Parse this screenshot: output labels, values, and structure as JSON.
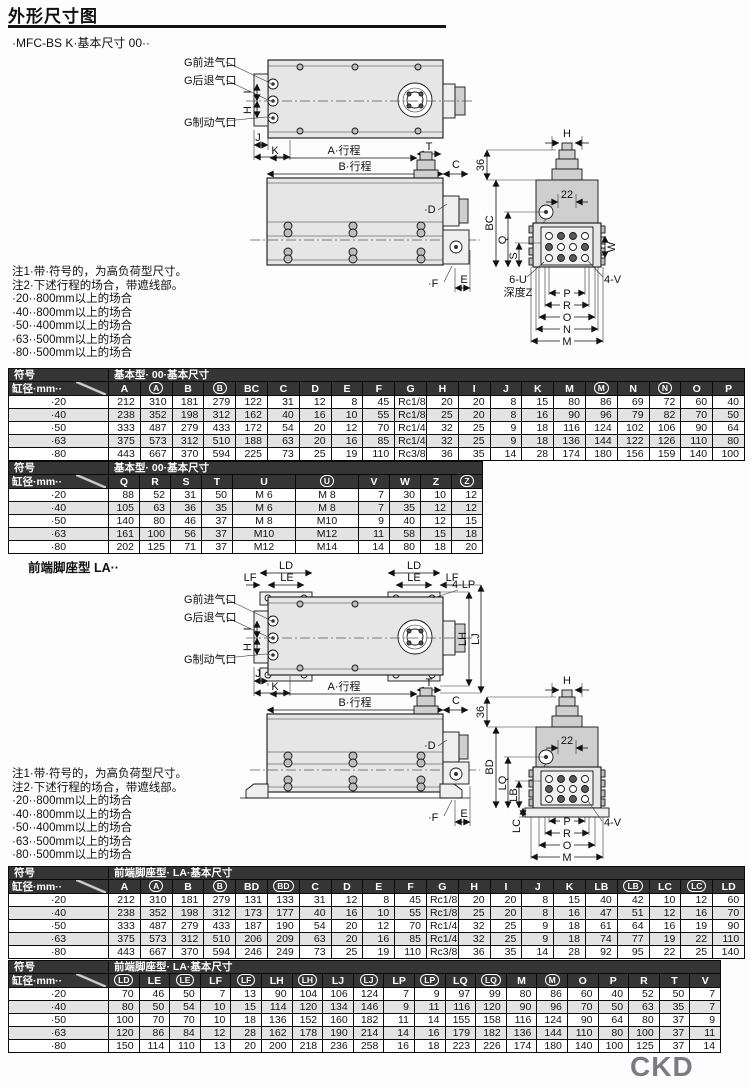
{
  "page": {
    "title": "外形尺寸图",
    "subtitle": "·MFC-BS K·基本尺寸 00··",
    "section2_heading": "前端脚座型 LA··",
    "brand": "CKD"
  },
  "notes": {
    "note1": "注1·带·符号的，为高负荷型尺寸。",
    "note2": "注2·下述行程的场合，带遮线部。",
    "bullets": [
      "·20··800mm以上的场合",
      "·40··800mm以上的场合",
      "·50··400mm以上的场合",
      "·63··500mm以上的场合",
      "·80··500mm以上的场合"
    ]
  },
  "drawing1": {
    "ports": {
      "advance": "G前进气口",
      "retract": "G后退气口",
      "brake": "G制动气口"
    },
    "dims": {
      "port_i": "I",
      "port_h": "H",
      "j": "J",
      "k": "K",
      "a_stroke": "A·行程",
      "b_stroke": "B·行程",
      "t": "T",
      "c": "C",
      "d": "·D",
      "e": "E",
      "f": "·F",
      "ev_h": "H",
      "n36": "36",
      "n22": "22",
      "bc": "BC",
      "q": "Q",
      "s": "S",
      "w": "W",
      "u6": "6-U",
      "depth_z": "深度Z",
      "v4": "4-V",
      "p": "P",
      "r": "R",
      "o": "O",
      "n": "N",
      "m": "M"
    }
  },
  "drawing2": {
    "ports": {
      "advance": "G前进气口",
      "retract": "G后退气口",
      "brake": "G制动气口"
    },
    "dims": {
      "ld": "LD",
      "le": "LE",
      "lf": "LF",
      "lp4": "4-LP",
      "lh": "LH",
      "lj": "LJ",
      "port_i": "I",
      "port_h": "H",
      "j": "J",
      "k": "K",
      "a_stroke": "A·行程",
      "b_stroke": "B·行程",
      "t": "T",
      "c": "C",
      "d": "·D",
      "e": "E",
      "f": "·F",
      "ev_h": "H",
      "n36": "36",
      "n22": "22",
      "bd": "BD",
      "lq": "LQ",
      "lb": "LB",
      "lc": "LC",
      "v4": "4-V",
      "p": "P",
      "r": "R",
      "o": "O",
      "m": "M"
    }
  },
  "tables": {
    "t1": {
      "symbol_label": "符号",
      "bore_label": "缸径·mm··",
      "title": "基本型· 00·基本尺寸",
      "columns": [
        "A",
        "(A)",
        "B",
        "(B)",
        "BC",
        "C",
        "D",
        "E",
        "F",
        "G",
        "H",
        "I",
        "J",
        "K",
        "M",
        "(M)",
        "N",
        "(N)",
        "O",
        "P"
      ],
      "rows": [
        {
          "label": "·20",
          "values": [
            212,
            310,
            181,
            279,
            122,
            31,
            12,
            8,
            45,
            "Rc1/8",
            20,
            20,
            8,
            15,
            80,
            86,
            69,
            72,
            60,
            40
          ]
        },
        {
          "label": "·40",
          "values": [
            238,
            352,
            198,
            312,
            162,
            40,
            16,
            10,
            55,
            "Rc1/8",
            25,
            20,
            8,
            16,
            90,
            96,
            79,
            82,
            70,
            50
          ]
        },
        {
          "label": "·50",
          "values": [
            333,
            487,
            279,
            433,
            172,
            54,
            20,
            12,
            70,
            "Rc1/4",
            32,
            25,
            9,
            18,
            116,
            124,
            102,
            106,
            90,
            64
          ]
        },
        {
          "label": "·63",
          "values": [
            375,
            573,
            312,
            510,
            188,
            63,
            20,
            16,
            85,
            "Rc1/4",
            32,
            25,
            9,
            18,
            136,
            144,
            122,
            126,
            110,
            80
          ]
        },
        {
          "label": "·80",
          "values": [
            443,
            667,
            370,
            594,
            225,
            73,
            25,
            19,
            110,
            "Rc3/8",
            36,
            35,
            14,
            28,
            174,
            180,
            156,
            159,
            140,
            100
          ]
        }
      ]
    },
    "t2": {
      "symbol_label": "符号",
      "bore_label": "缸径·mm··",
      "title": "基本型· 00·基本尺寸",
      "columns": [
        "Q",
        "R",
        "S",
        "T",
        "U",
        "(U)",
        "V",
        "W",
        "Z",
        "(Z)"
      ],
      "rows": [
        {
          "label": "·20",
          "values": [
            88,
            52,
            31,
            50,
            "M 6",
            "M 8",
            7,
            30,
            10,
            12
          ]
        },
        {
          "label": "·40",
          "values": [
            105,
            63,
            36,
            35,
            "M 6",
            "M 8",
            7,
            35,
            12,
            12
          ]
        },
        {
          "label": "·50",
          "values": [
            140,
            80,
            46,
            37,
            "M 8",
            "M10",
            9,
            40,
            12,
            15
          ]
        },
        {
          "label": "·63",
          "values": [
            161,
            100,
            56,
            37,
            "M10",
            "M12",
            11,
            58,
            15,
            18
          ]
        },
        {
          "label": "·80",
          "values": [
            202,
            125,
            71,
            37,
            "M12",
            "M14",
            14,
            80,
            18,
            20
          ]
        }
      ]
    },
    "t3": {
      "symbol_label": "符号",
      "bore_label": "缸径·mm··",
      "title": "前端脚座型· LA·基本尺寸",
      "columns": [
        "A",
        "(A)",
        "B",
        "(B)",
        "BD",
        "(BD)",
        "C",
        "D",
        "E",
        "F",
        "G",
        "H",
        "I",
        "J",
        "K",
        "LB",
        "(LB)",
        "LC",
        "(LC)",
        "LD"
      ],
      "rows": [
        {
          "label": "·20",
          "values": [
            212,
            310,
            181,
            279,
            131,
            133,
            31,
            12,
            8,
            45,
            "Rc1/8",
            20,
            20,
            8,
            15,
            40,
            42,
            10,
            12,
            60
          ]
        },
        {
          "label": "·40",
          "values": [
            238,
            352,
            198,
            312,
            173,
            177,
            40,
            16,
            10,
            55,
            "Rc1/8",
            25,
            20,
            8,
            16,
            47,
            51,
            12,
            16,
            70
          ]
        },
        {
          "label": "·50",
          "values": [
            333,
            487,
            279,
            433,
            187,
            190,
            54,
            20,
            12,
            70,
            "Rc1/4",
            32,
            25,
            9,
            18,
            61,
            64,
            16,
            19,
            90
          ]
        },
        {
          "label": "·63",
          "values": [
            375,
            573,
            312,
            510,
            206,
            209,
            63,
            20,
            16,
            85,
            "Rc1/4",
            32,
            25,
            9,
            18,
            74,
            77,
            19,
            22,
            110
          ]
        },
        {
          "label": "·80",
          "values": [
            443,
            667,
            370,
            594,
            246,
            249,
            73,
            25,
            19,
            110,
            "Rc3/8",
            36,
            35,
            14,
            28,
            92,
            95,
            22,
            25,
            140
          ]
        }
      ]
    },
    "t4": {
      "symbol_label": "符号",
      "bore_label": "缸径·mm··",
      "title": "前端脚座型· LA·基本尺寸",
      "columns": [
        "(LD)",
        "LE",
        "(LE)",
        "LF",
        "(LF)",
        "LH",
        "(LH)",
        "LJ",
        "(LJ)",
        "LP",
        "(LP)",
        "LQ",
        "(LQ)",
        "M",
        "(M)",
        "O",
        "P",
        "R",
        "T",
        "V"
      ],
      "rows": [
        {
          "label": "·20",
          "values": [
            70,
            46,
            50,
            7,
            13,
            90,
            104,
            106,
            124,
            7,
            9,
            97,
            99,
            80,
            86,
            60,
            40,
            52,
            50,
            7
          ]
        },
        {
          "label": "·40",
          "values": [
            80,
            50,
            54,
            10,
            15,
            114,
            120,
            134,
            146,
            9,
            11,
            116,
            120,
            90,
            96,
            70,
            50,
            63,
            35,
            7
          ]
        },
        {
          "label": "·50",
          "values": [
            100,
            70,
            70,
            10,
            18,
            136,
            152,
            160,
            182,
            11,
            14,
            155,
            158,
            116,
            124,
            90,
            64,
            80,
            37,
            9
          ]
        },
        {
          "label": "·63",
          "values": [
            120,
            86,
            84,
            12,
            28,
            162,
            178,
            190,
            214,
            14,
            16,
            179,
            182,
            136,
            144,
            110,
            80,
            100,
            37,
            11
          ]
        },
        {
          "label": "·80",
          "values": [
            150,
            114,
            110,
            13,
            20,
            200,
            218,
            236,
            258,
            16,
            18,
            223,
            226,
            174,
            180,
            140,
            100,
            125,
            37,
            14
          ]
        }
      ]
    }
  }
}
